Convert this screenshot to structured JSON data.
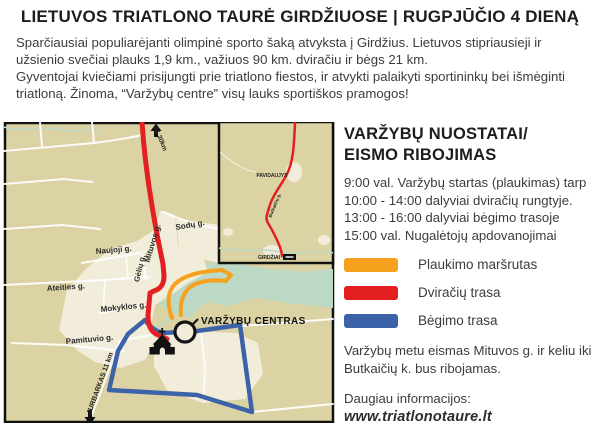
{
  "title": "LIETUVOS TRIATLONO TAURĖ GIRDŽIUOSE | RUGPJŪČIO 4 DIENĄ",
  "intro": {
    "p1": "Sparčiausiai populiarėjanti olimpinė sporto šaką atvyksta į Girdžius. Lietuvos stipriausieji ir užsienio svečiai plauks 1,9 km., važiuos 90 km. dviračiu ir bėgs 21 km.",
    "p2": "Gyventojai kviečiami prisijungti prie triatlono fiestos, ir atvykti palaikyti sportininkų bei išmėginti triatloną. Žinoma, “Varžybų centre” visų lauks sportiškos pramogos!"
  },
  "rules": {
    "heading1": "VARŽYBŲ NUOSTATAI/",
    "heading2": "EISMO RIBOJIMAS",
    "schedule": [
      "9:00 val. Varžybų startas (plaukimas) tarp 10:00 - 14:00 dalyviai dviračių rungtyje.",
      "13:00 - 16:00 dalyviai bėgimo trasoje",
      "15:00 val. Nugalėtojų apdovanojimai"
    ],
    "restriction": "Varžybų metu eismas Mituvos g. ir keliu iki Butkaičių k. bus ribojamas.",
    "more_info": "Daugiau informacijos:",
    "website": "www.triatlonotaure.lt"
  },
  "legend": [
    {
      "label": "Plaukimo maršrutas",
      "color": "#F5A11E"
    },
    {
      "label": "Dviračių trasa",
      "color": "#E31F21"
    },
    {
      "label": "Bėgimo trasa",
      "color": "#3C63A9"
    }
  ],
  "map": {
    "highway_label": "A1 30km",
    "jurbarkas_label": "JURBARKAS 11 km",
    "center_label": "VARŽYBŲ CENTRAS",
    "streets": [
      "Mituvos g.",
      "Sodų g.",
      "Naujoji g.",
      "Gėlių g.",
      "Ateities g.",
      "Mokyklos g.",
      "Pamituvio g."
    ],
    "inset": {
      "town1": "PAVIDAUJYS",
      "town2": "GIRDŽIAI",
      "road": "Butkaičių g."
    },
    "colors": {
      "swim": "#F5A11E",
      "bike": "#E31F21",
      "run": "#3C63A9",
      "land": "#DCD3A4",
      "builtup": "#F2ECDA",
      "water": "#BCD9C6"
    }
  }
}
